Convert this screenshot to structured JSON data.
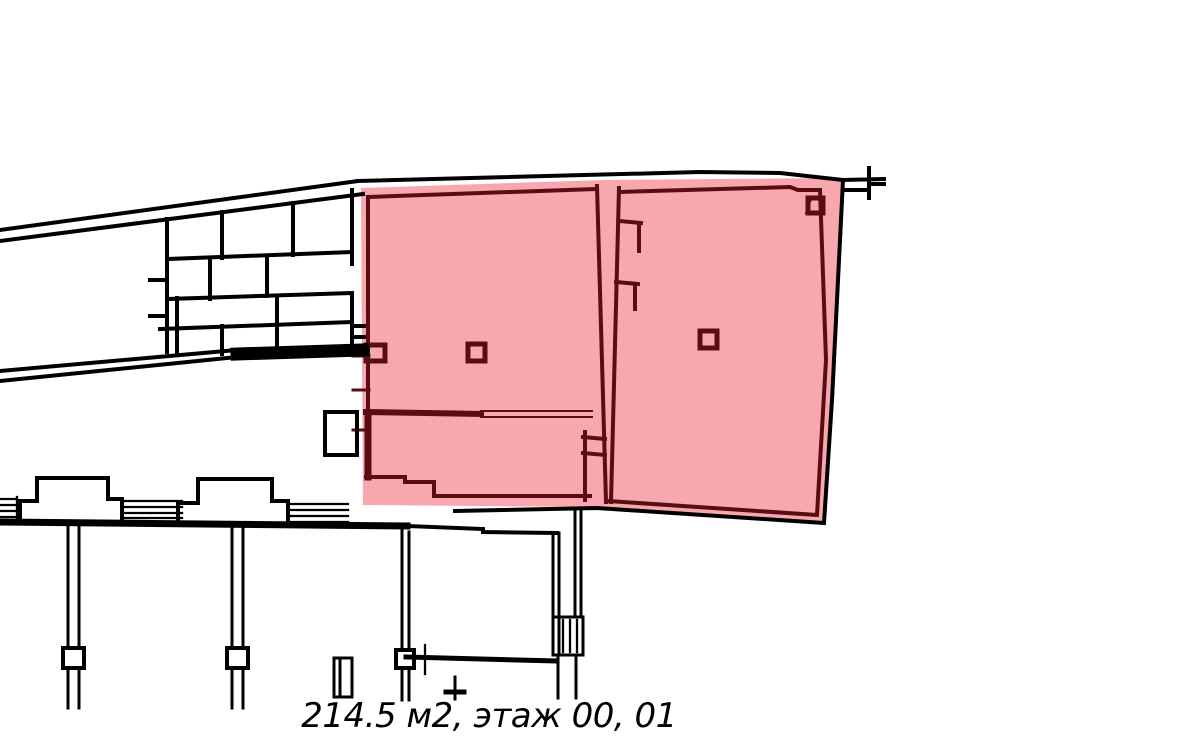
{
  "caption": {
    "text": "214.5 м2, этаж 00, 01",
    "area": "214.5 м2",
    "floors": "этаж 00, 01"
  },
  "colors": {
    "background": "#ffffff",
    "wall": "#000000",
    "highlight_fill": "#f7a7ad",
    "highlight_wall": "#570d11"
  },
  "highlight": {
    "name": "highlighted-unit",
    "points": "361,188 605,180 843,178 831,400 824,522 597,507 363,505"
  }
}
